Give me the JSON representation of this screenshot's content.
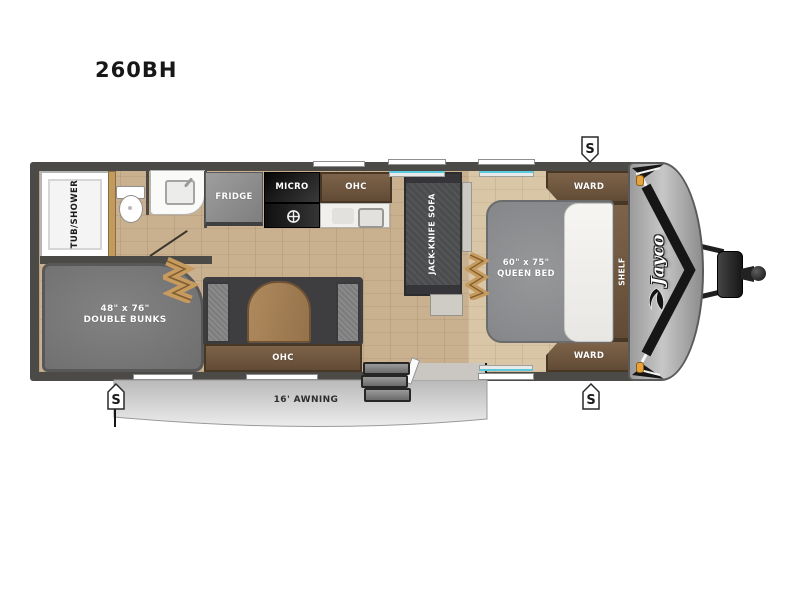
{
  "title": "260BH",
  "brand": "Jayco",
  "floorplan": {
    "labels": {
      "tub_shower": "TUB/SHOWER",
      "fridge": "FRIDGE",
      "micro": "MICRO",
      "kitchen_ohc": "OHC",
      "dinette_ohc": "OHC",
      "sofa": "JACK-KNIFE SOFA",
      "bunks_size": "48\" x 76\"",
      "bunks_name": "DOUBLE BUNKS",
      "bed_size": "60\" x 75\"",
      "bed_name": "QUEEN BED",
      "ward_top": "WARD",
      "ward_bottom": "WARD",
      "shelf": "SHELF",
      "awning": "16' AWNING",
      "stabilizer": "S"
    },
    "colors": {
      "wall": "#4c4a47",
      "floor_wood": "#c9b190",
      "bedroom_floor": "#d9c6a6",
      "cabinet_wood": "#6e5640",
      "accordion_tan": "#c79a5e",
      "front_cap_gray": "#c0c0c0",
      "window_glass": "#5bc8dc",
      "marker_light_amber": "#e8a33d"
    }
  }
}
